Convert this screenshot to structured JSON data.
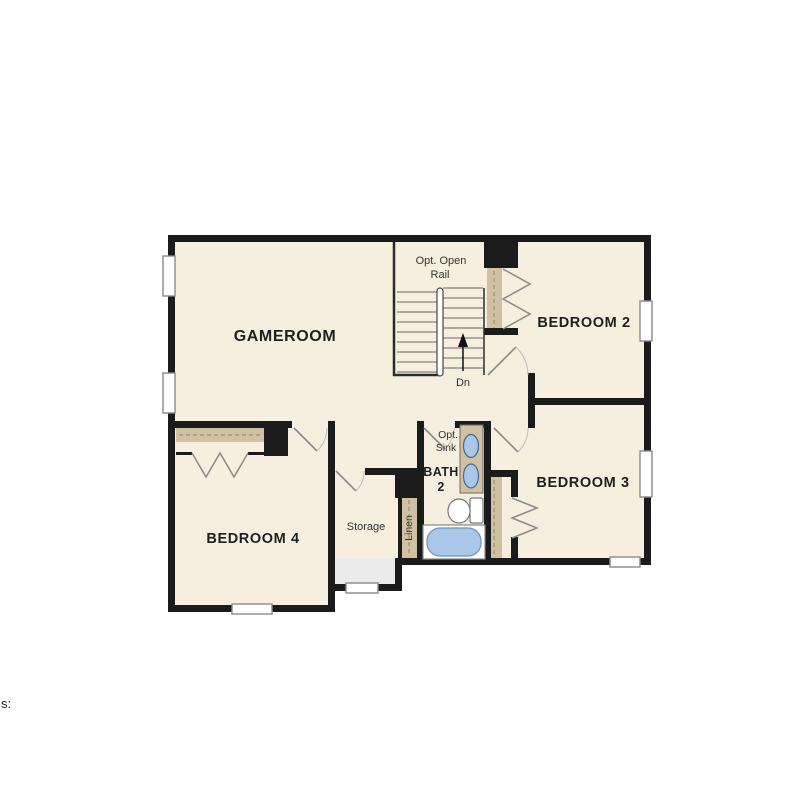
{
  "palette": {
    "background": "#ffffff",
    "wall": "#1b1b1b",
    "floor": "#f6eedf",
    "closet_shelf": "#cfc1a2",
    "fixture_blue": "#a9c8e8",
    "understair_gray": "#ebebec",
    "window_fill": "#ffffff",
    "door_swing": "#8a8a8a"
  },
  "labels": {
    "gameroom": "GAMEROOM",
    "bedroom2": "BEDROOM 2",
    "bedroom3": "BEDROOM 3",
    "bedroom4": "BEDROOM 4",
    "bath_line1": "BATH",
    "bath_line2": "2",
    "storage": "Storage",
    "linen": "Linen",
    "stairs_note_line1": "Opt. Open",
    "stairs_note_line2": "Rail",
    "stairs_direction": "Dn",
    "sink_note_line1": "Opt.",
    "sink_note_line2": "Sink",
    "partial_text": "s:"
  }
}
